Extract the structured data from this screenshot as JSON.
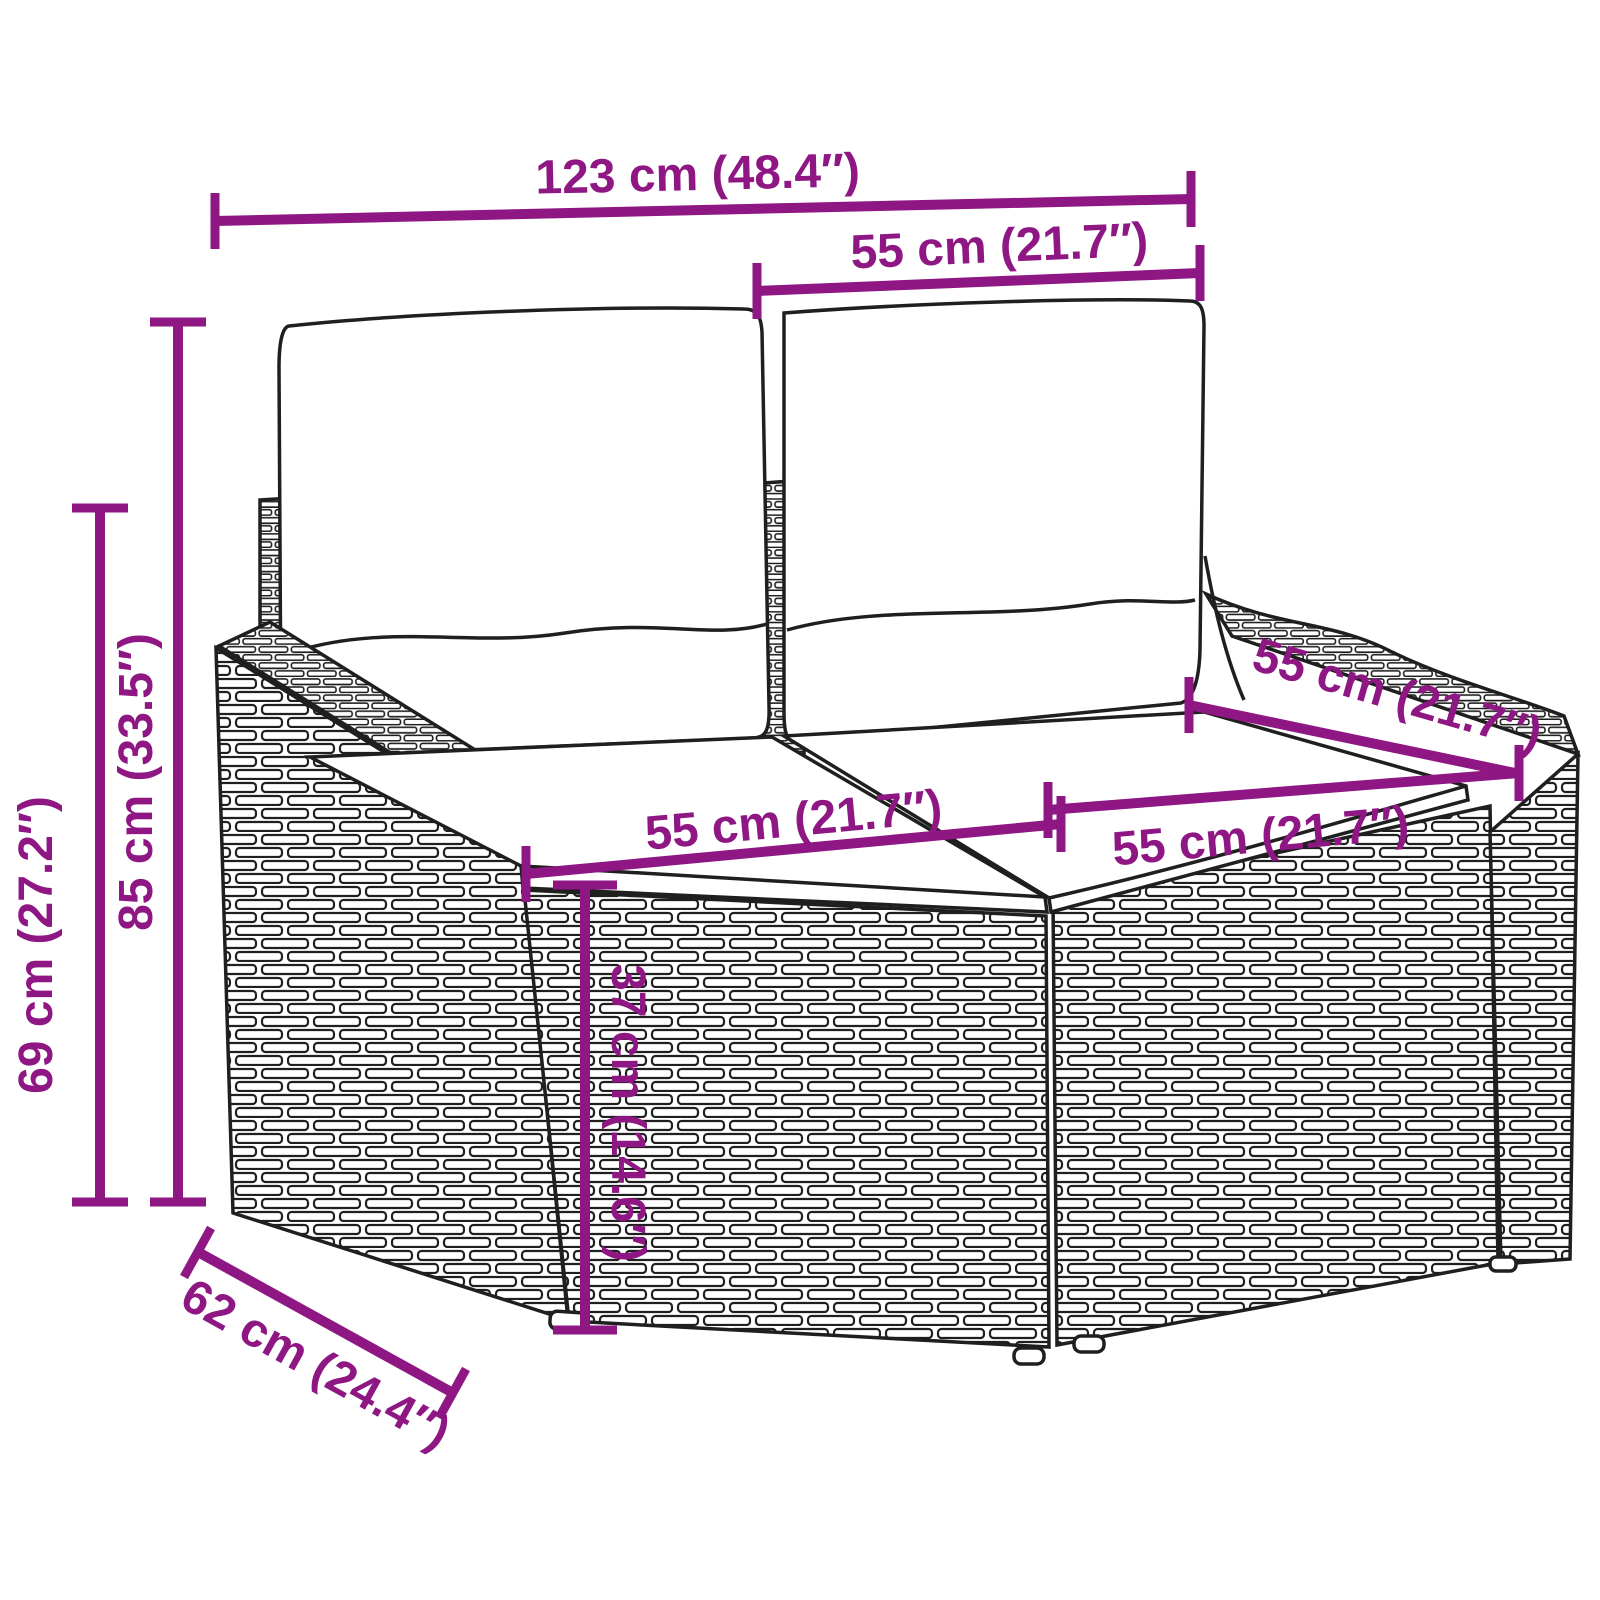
{
  "diagram": {
    "kind": "product-dimension-diagram",
    "product": "rattan-garden-2-seater-sofa-with-cushions",
    "style": {
      "dimension_color": "#8E1784",
      "line_art_color": "#1f1f1f",
      "background_color": "#ffffff"
    },
    "dimensions": {
      "overall_width": {
        "label": "123 cm (48.4″)"
      },
      "back_cushion_width": {
        "label": "55 cm (21.7″)"
      },
      "overall_height": {
        "label": "85 cm (33.5″)"
      },
      "armrest_height": {
        "label": "69 cm (27.2″)"
      },
      "seat_cushion_width_left": {
        "label": "55 cm (21.7″)"
      },
      "seat_cushion_width_right": {
        "label": "55 cm (21.7″)"
      },
      "seat_depth": {
        "label": "55 cm (21.7″)"
      },
      "seat_height": {
        "label": "37 cm (14.6″)"
      },
      "overall_depth": {
        "label": "62 cm (24.4″)"
      }
    }
  }
}
